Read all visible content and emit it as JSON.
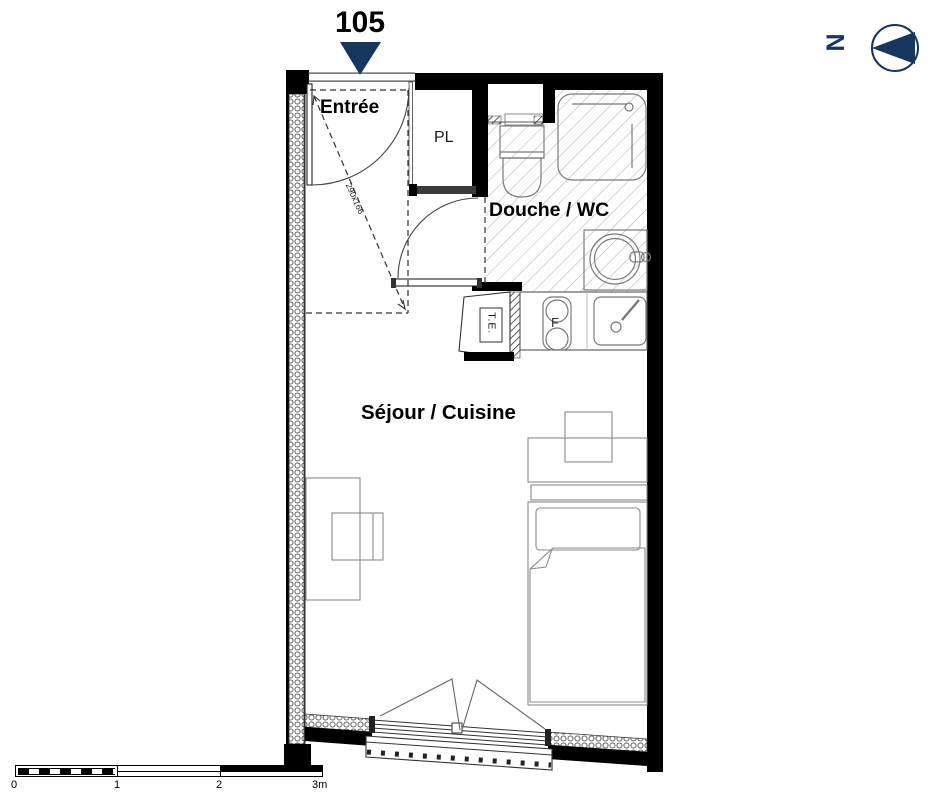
{
  "header": {
    "unit_number": "105"
  },
  "compass": {
    "letter": "N"
  },
  "rooms": {
    "entree": "Entrée",
    "closet": "PL",
    "bathroom": "Douche / WC",
    "living": "Séjour / Cuisine"
  },
  "annotations": {
    "entry_dimension": "290x166",
    "electrical_panel": "T.E.",
    "stove_letter": "F"
  },
  "scale_bar": {
    "ticks": [
      "0",
      "1",
      "2",
      "3m"
    ]
  },
  "colors": {
    "accent_navy": "#17365d",
    "wall_black": "#000000"
  }
}
